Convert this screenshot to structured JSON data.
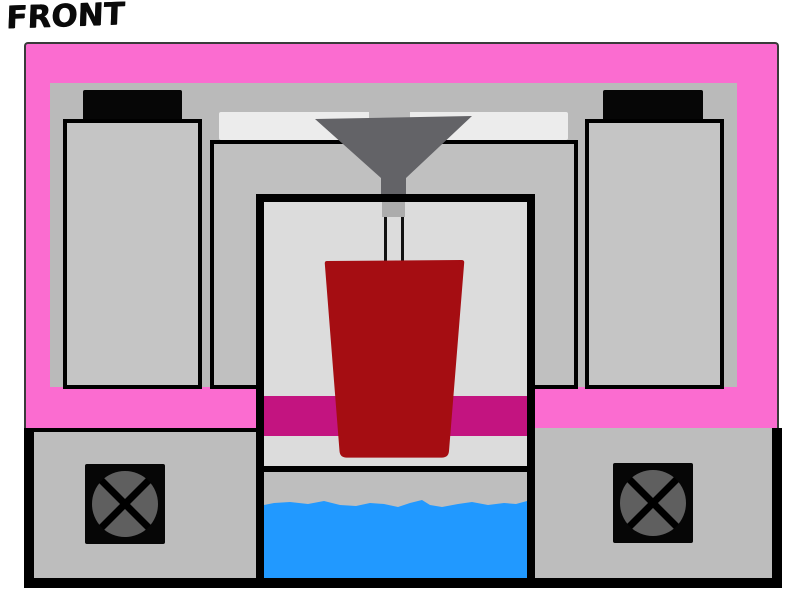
{
  "title": {
    "label": "FRONT"
  },
  "parts": [
    "outer-frame",
    "inner-panel",
    "top-strip",
    "left-tower",
    "left-tower-cap",
    "right-tower",
    "right-tower-cap",
    "middle-box",
    "hopper-funnel",
    "feed-stem",
    "feed-rod",
    "build-chamber",
    "magenta-band",
    "chamber-divider",
    "red-vessel",
    "liquid-reservoir",
    "bottom-left-unit",
    "bottom-right-unit",
    "left-fan",
    "right-fan",
    "base-bar"
  ],
  "colors": {
    "frame_pink": "#FB6CD0",
    "frame_outline": "#3A3A3A",
    "panel_gray": "#BABABA",
    "strip_light": "#ECECEC",
    "tower_gray": "#C5C5C5",
    "cap_black": "#060606",
    "box_gray": "#C0C0C0",
    "funnel_gray": "#636367",
    "stem_gray": "#ACACAC",
    "chamber_light": "#DCDCDC",
    "band_magenta": "#C31480",
    "lower_gray": "#BEBEBE",
    "liquid_blue": "#2199FF",
    "vessel_red": "#A50D12",
    "bottom_box_gray": "#BDBDBD",
    "fan_gray": "#5F5F5F",
    "ink_black": "#000000"
  }
}
